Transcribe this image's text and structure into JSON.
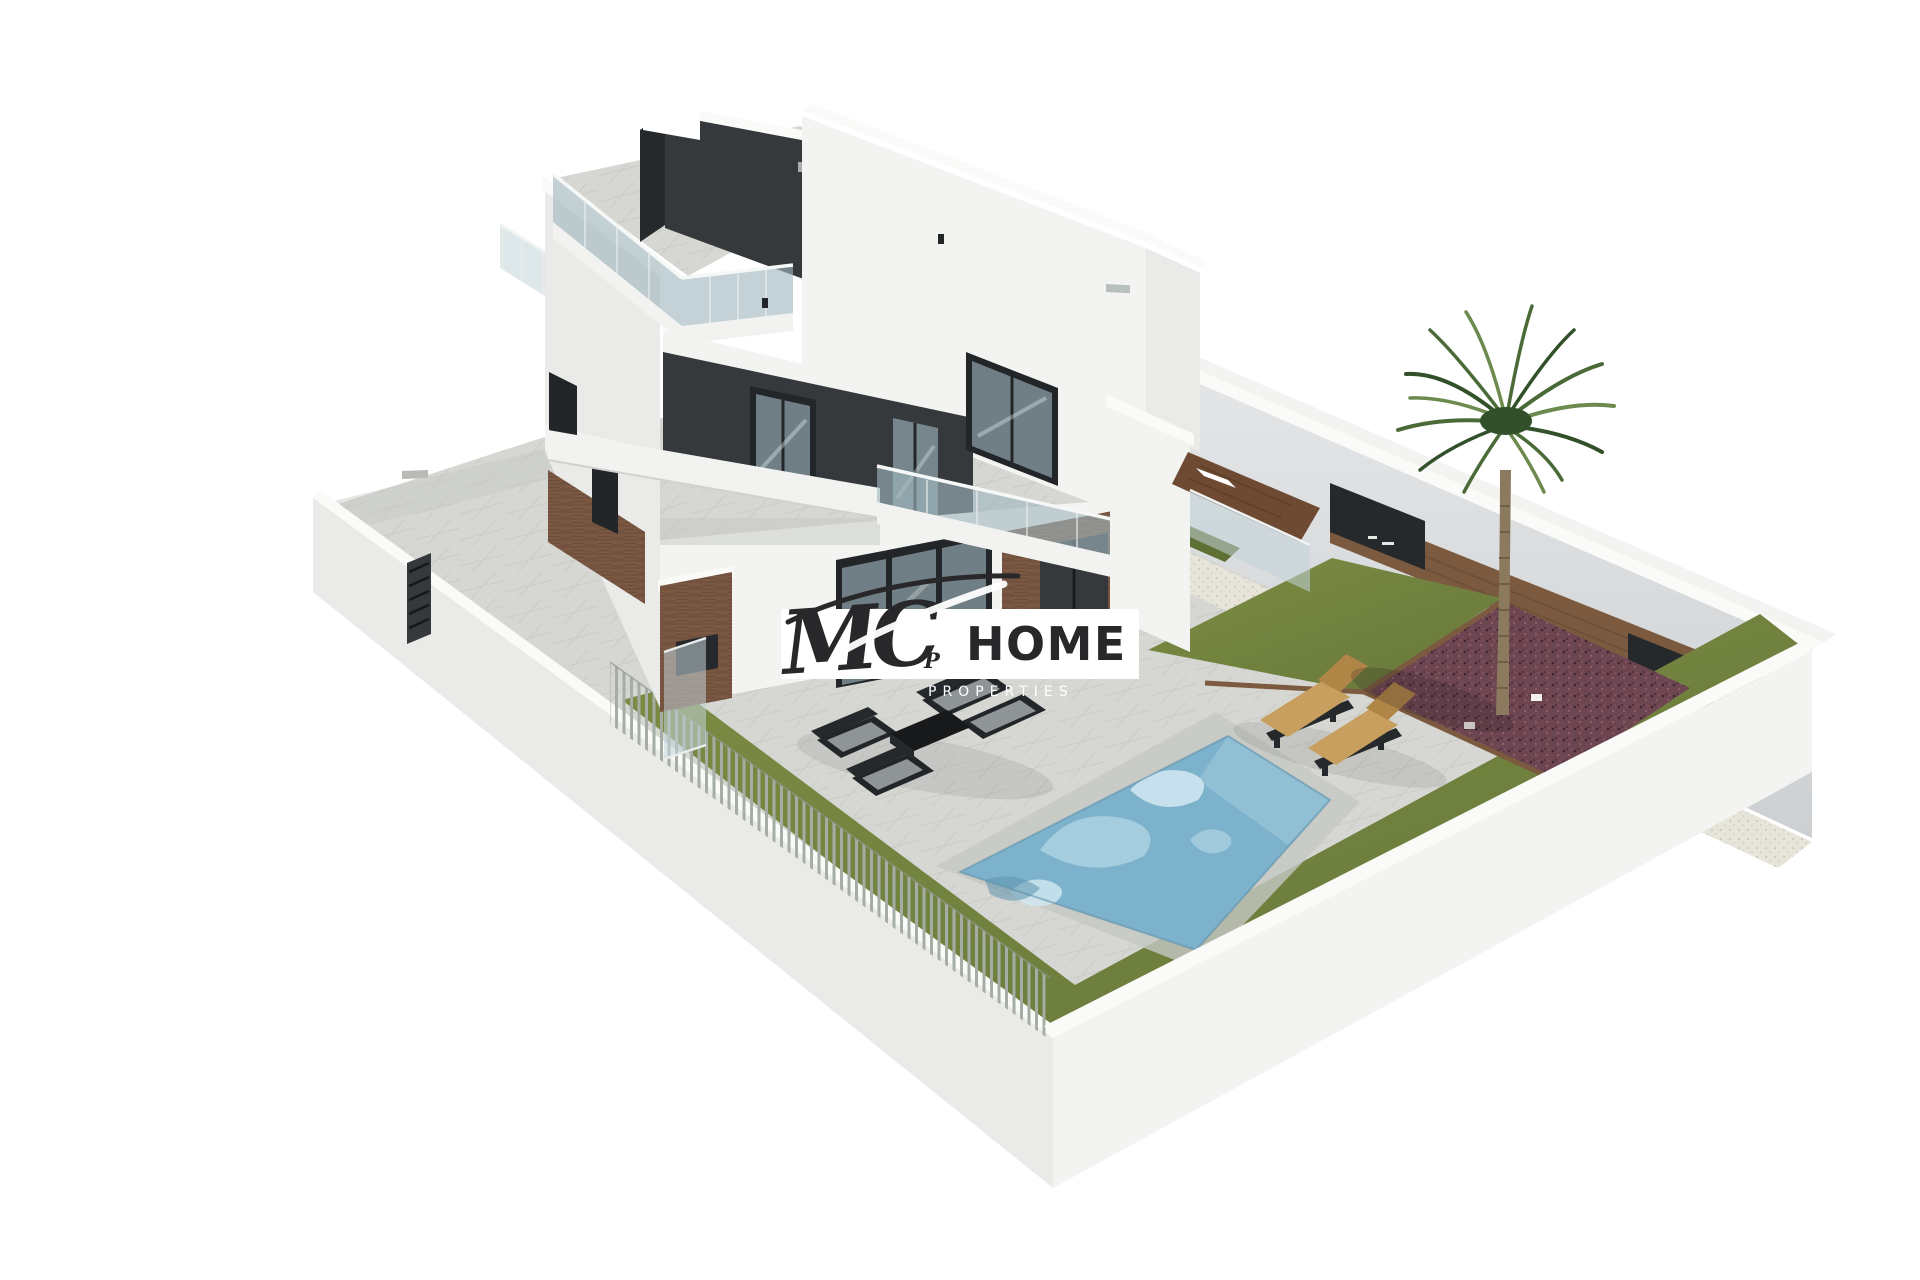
{
  "meta": {
    "type": "architectural-3d-render",
    "description": "Isometric 3D rendering of a modern three-storey white villa with roof terrace, glass balustrades, swimming pool, sun loungers, lounge furniture, lawn, gravel beds and a palm tree inside a white-walled plot",
    "background": "#ffffff"
  },
  "logo": {
    "monogram": "MC",
    "monogram_tail": "P",
    "word": "HOME",
    "subtitle": "PROPERTIES"
  },
  "palette": {
    "background": "#ffffff",
    "paving": "#d6d7d3",
    "paving_shadow": "#c6c8c4",
    "tile_line": "#bfc1bd",
    "wall_white": "#f3f4f1",
    "wall_cap": "#fafaf8",
    "wall_shade": "#eaebe8",
    "wall_inner": "#dcdee0",
    "charcoal": "#35393b",
    "charcoal_dark": "#26292b",
    "frame_dark": "#232628",
    "glass": "#9fb6bf",
    "glass_light": "#c3d4d9",
    "slab": "#f2f3f0",
    "stone": "#7b5842",
    "stone_line": "#5d4232",
    "lawn": "#76863f",
    "lawn_dark": "#5f7034",
    "mulch": "#6d4651",
    "mulch_dark": "#3f2731",
    "mulch_light": "#935f6d",
    "gravel": "#e7e5da",
    "gravel_dot": "#bdbaa9",
    "wood": "#7b5a3f",
    "trunk": "#8b7a5e",
    "trunk_ring": "#6f5f46",
    "frond": "#4a6b38",
    "frond_dark": "#32512a",
    "frond_light": "#6d8a4e",
    "tan": "#c89f5e",
    "tan_dark": "#b08647",
    "cushion": "#8f9597",
    "pool": "#7db2cc",
    "pool_light": "#a9d0e0",
    "pool_lighter": "#d2e9f2",
    "pool_wall": "#93c0d5",
    "pool_deep": "#5f93ad",
    "fence": "#a6ada5",
    "ink": "#28282a"
  }
}
